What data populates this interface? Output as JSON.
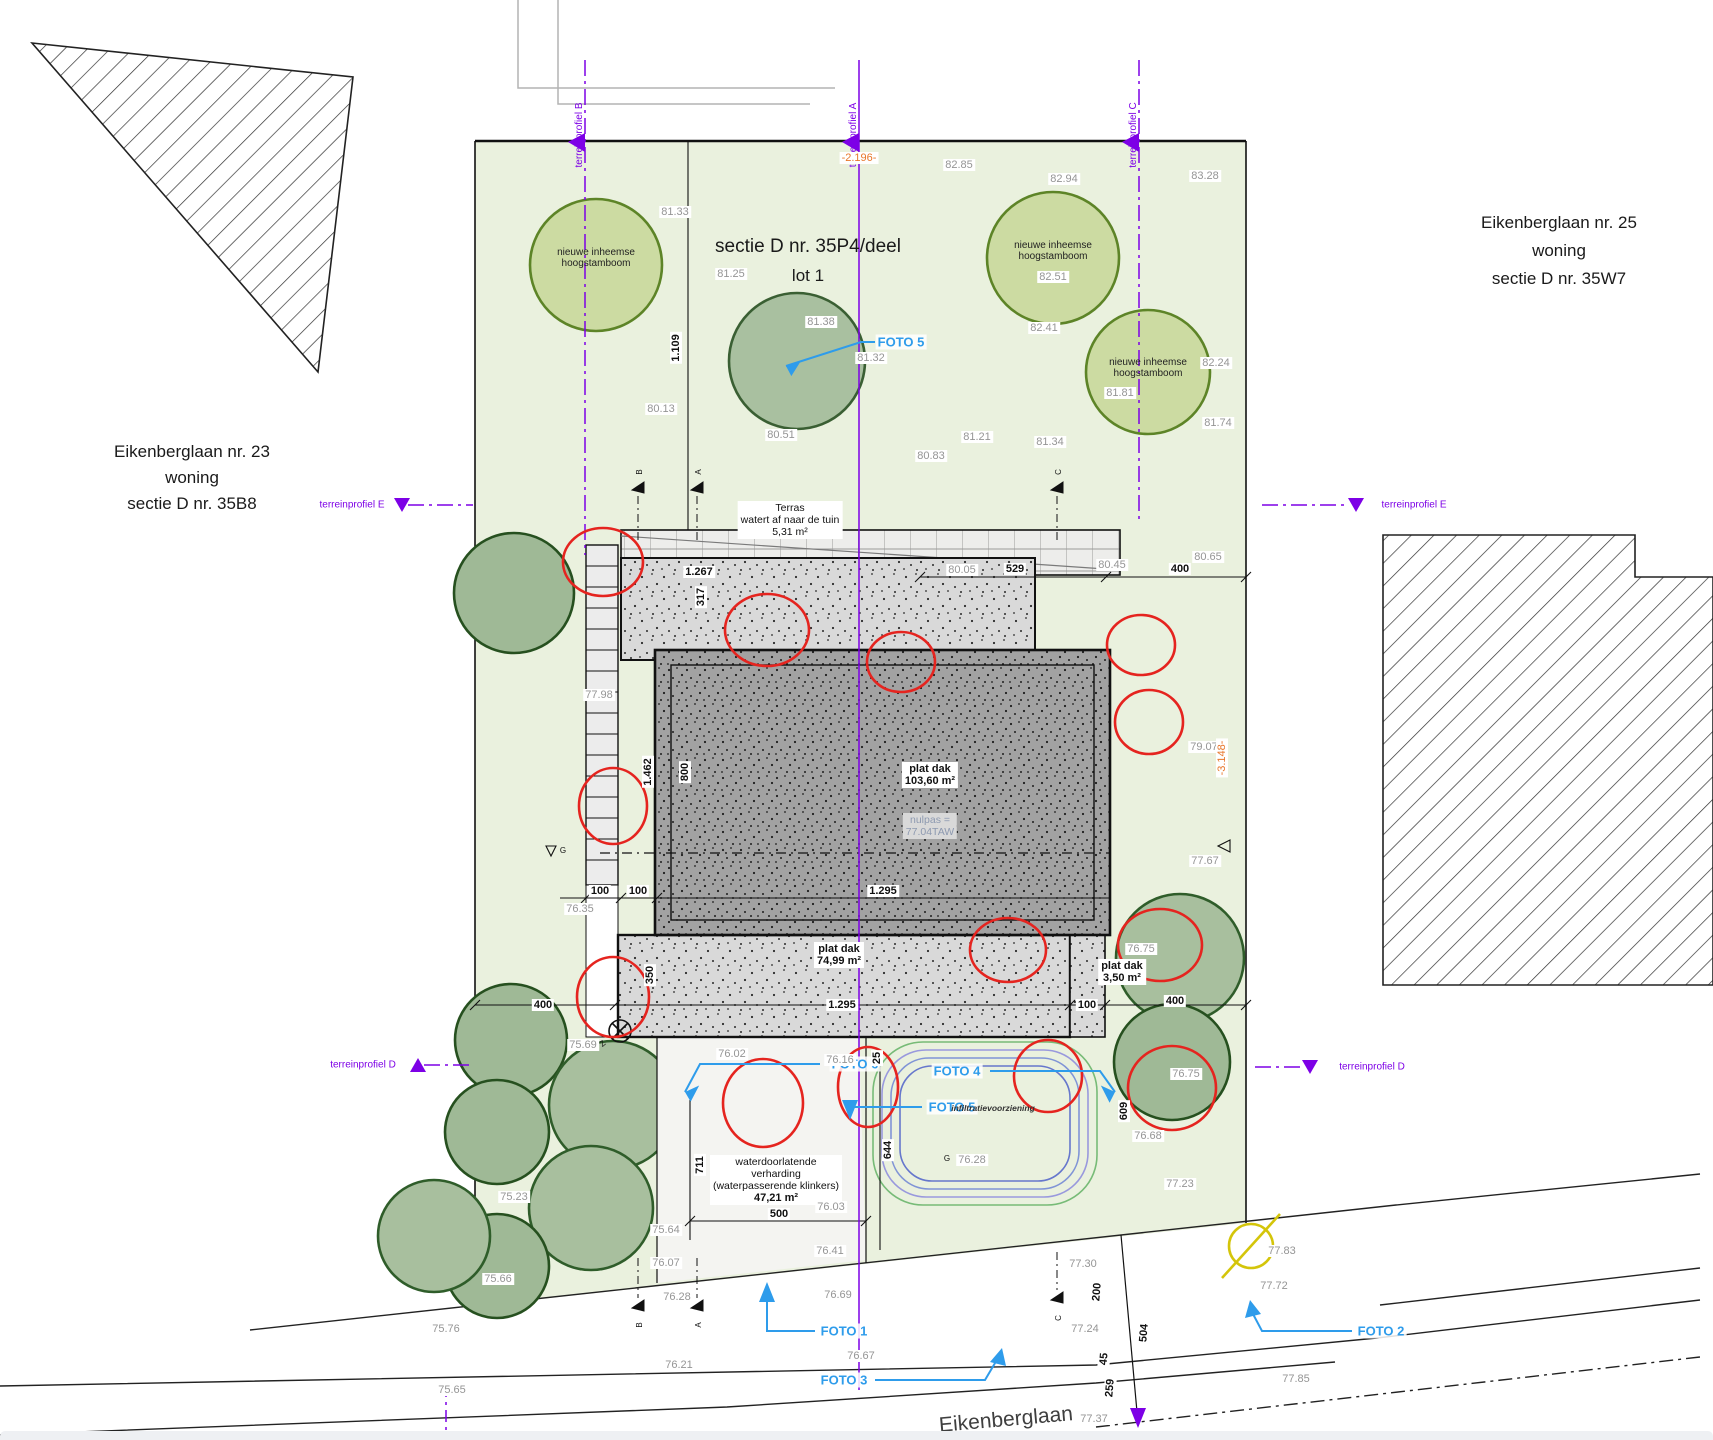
{
  "colors": {
    "site_green": "#eaf1de",
    "tree_light": "#ccdba2",
    "tree_light_stroke": "#5d8427",
    "tree_sage": "#a9c0a0",
    "tree_sage_stroke": "#2f5d2a",
    "roof_light": "#d9d9d9",
    "roof_dark": "#a2a2a2",
    "purple": "#7d00e6",
    "foto_blue": "#2e9ceb",
    "orange": "#e8762a",
    "red": "#e5241f",
    "yellow": "#d4c50a",
    "spot_gray": "#959595"
  },
  "title": {
    "line1": "sectie D nr. 35P4/deel",
    "line2": "lot 1"
  },
  "neighbors": {
    "left": {
      "line1": "Eikenberglaan nr. 23",
      "line2": "woning",
      "line3": "sectie D nr. 35B8"
    },
    "right": {
      "line1": "Eikenberglaan nr. 25",
      "line2": "woning",
      "line3": "sectie D nr. 35W7"
    }
  },
  "street": {
    "name": "Eikenberglaan"
  },
  "profiles": {
    "a": "terreinprofiel A",
    "b": "terreinprofiel B",
    "c": "terreinprofiel C",
    "d_left": "terreinprofiel D",
    "d_right": "terreinprofiel D",
    "e_left": "terreinprofiel E",
    "e_right": "terreinprofiel E"
  },
  "fotos": {
    "f1": "FOTO 1",
    "f2": "FOTO 2",
    "f3": "FOTO 3",
    "f4": "FOTO 4",
    "f5_top": "FOTO 5",
    "f5_bottom": "FOTO 5",
    "f6": "FOTO 6"
  },
  "tree_label": {
    "line1": "nieuwe inheemse",
    "line2": "hoogstamboom"
  },
  "house": {
    "terras": {
      "line1": "Terras",
      "line2": "watert af naar de tuin",
      "line3": "5,31 m²"
    },
    "roof_main": {
      "line1": "plat dak",
      "line2": "103,60 m²"
    },
    "nulpas": {
      "line1": "nulpas =",
      "line2": "77.04TAW"
    },
    "roof_low": {
      "line1": "plat dak",
      "line2": "74,99 m²"
    },
    "roof_small": {
      "line1": "plat dak",
      "line2": "3,50 m²"
    },
    "paving": {
      "line1": "waterdoorlatende",
      "line2": "verharding",
      "line3": "(waterpasserende klinkers)",
      "line4": "47,21 m²"
    },
    "infiltration": "infiltratievoorziening"
  },
  "spot_heights": [
    {
      "x": 675,
      "y": 212,
      "v": "81.33"
    },
    {
      "x": 731,
      "y": 274,
      "v": "81.25"
    },
    {
      "x": 821,
      "y": 322,
      "v": "81.38"
    },
    {
      "x": 871,
      "y": 358,
      "v": "81.32"
    },
    {
      "x": 661,
      "y": 409,
      "v": "80.13"
    },
    {
      "x": 781,
      "y": 435,
      "v": "80.51"
    },
    {
      "x": 931,
      "y": 456,
      "v": "80.83"
    },
    {
      "x": 977,
      "y": 437,
      "v": "81.21"
    },
    {
      "x": 1050,
      "y": 442,
      "v": "81.34"
    },
    {
      "x": 959,
      "y": 165,
      "v": "82.85"
    },
    {
      "x": 1064,
      "y": 179,
      "v": "82.94"
    },
    {
      "x": 1205,
      "y": 176,
      "v": "83.28"
    },
    {
      "x": 1053,
      "y": 277,
      "v": "82.51"
    },
    {
      "x": 1044,
      "y": 328,
      "v": "82.41"
    },
    {
      "x": 1216,
      "y": 363,
      "v": "82.24"
    },
    {
      "x": 1120,
      "y": 393,
      "v": "81.81"
    },
    {
      "x": 1218,
      "y": 423,
      "v": "81.74"
    },
    {
      "x": 1208,
      "y": 557,
      "v": "80.65"
    },
    {
      "x": 1112,
      "y": 565,
      "v": "80.45"
    },
    {
      "x": 962,
      "y": 570,
      "v": "80.05"
    },
    {
      "x": 599,
      "y": 695,
      "v": "77.98"
    },
    {
      "x": 1204,
      "y": 747,
      "v": "79.07"
    },
    {
      "x": 1205,
      "y": 861,
      "v": "77.67"
    },
    {
      "x": 580,
      "y": 909,
      "v": "76.35"
    },
    {
      "x": 583,
      "y": 1045,
      "v": "75.69"
    },
    {
      "x": 732,
      "y": 1054,
      "v": "76.02"
    },
    {
      "x": 840,
      "y": 1060,
      "v": "76.16"
    },
    {
      "x": 1141,
      "y": 949,
      "v": "76.75"
    },
    {
      "x": 1186,
      "y": 1074,
      "v": "76.75"
    },
    {
      "x": 1148,
      "y": 1136,
      "v": "76.68"
    },
    {
      "x": 1180,
      "y": 1184,
      "v": "77.23"
    },
    {
      "x": 831,
      "y": 1207,
      "v": "76.03"
    },
    {
      "x": 830,
      "y": 1251,
      "v": "76.41"
    },
    {
      "x": 666,
      "y": 1230,
      "v": "75.64"
    },
    {
      "x": 666,
      "y": 1263,
      "v": "76.07"
    },
    {
      "x": 514,
      "y": 1197,
      "v": "75.23"
    },
    {
      "x": 498,
      "y": 1279,
      "v": "75.66"
    },
    {
      "x": 446,
      "y": 1329,
      "v": "75.76"
    },
    {
      "x": 677,
      "y": 1297,
      "v": "76.28"
    },
    {
      "x": 838,
      "y": 1295,
      "v": "76.69"
    },
    {
      "x": 679,
      "y": 1365,
      "v": "76.21"
    },
    {
      "x": 452,
      "y": 1390,
      "v": "75.65"
    },
    {
      "x": 861,
      "y": 1356,
      "v": "76.67"
    },
    {
      "x": 1083,
      "y": 1264,
      "v": "77.30"
    },
    {
      "x": 1085,
      "y": 1329,
      "v": "77.24"
    },
    {
      "x": 1274,
      "y": 1286,
      "v": "77.72"
    },
    {
      "x": 1282,
      "y": 1251,
      "v": "77.83"
    },
    {
      "x": 1296,
      "y": 1379,
      "v": "77.85"
    },
    {
      "x": 1094,
      "y": 1419,
      "v": "77.37"
    },
    {
      "x": 972,
      "y": 1160,
      "v": "76.28"
    }
  ],
  "dims": [
    {
      "x": 676,
      "y": 348,
      "v": "1.109",
      "r": -90
    },
    {
      "x": 1015,
      "y": 569,
      "v": "529",
      "r": 0
    },
    {
      "x": 1180,
      "y": 569,
      "v": "400",
      "r": 0
    },
    {
      "x": 699,
      "y": 572,
      "v": "1.267",
      "r": 0
    },
    {
      "x": 701,
      "y": 597,
      "v": "317",
      "r": -90
    },
    {
      "x": 648,
      "y": 772,
      "v": "1.462",
      "r": -90
    },
    {
      "x": 685,
      "y": 772,
      "v": "800",
      "r": -90
    },
    {
      "x": 600,
      "y": 891,
      "v": "100",
      "r": 0
    },
    {
      "x": 638,
      "y": 891,
      "v": "100",
      "r": 0
    },
    {
      "x": 883,
      "y": 891,
      "v": "1.295",
      "r": 0
    },
    {
      "x": 650,
      "y": 975,
      "v": "350",
      "r": -90
    },
    {
      "x": 543,
      "y": 1005,
      "v": "400",
      "r": 0
    },
    {
      "x": 842,
      "y": 1005,
      "v": "1.295",
      "r": 0
    },
    {
      "x": 1087,
      "y": 1005,
      "v": "100",
      "r": 0
    },
    {
      "x": 1175,
      "y": 1001,
      "v": "400",
      "r": 0
    },
    {
      "x": 877,
      "y": 1058,
      "v": "25",
      "r": -90
    },
    {
      "x": 888,
      "y": 1150,
      "v": "644",
      "r": -90
    },
    {
      "x": 700,
      "y": 1165,
      "v": "711",
      "r": -90
    },
    {
      "x": 779,
      "y": 1214,
      "v": "500",
      "r": 0
    },
    {
      "x": 1124,
      "y": 1111,
      "v": "609",
      "r": -90
    },
    {
      "x": 1097,
      "y": 1292,
      "v": "200",
      "r": -85
    },
    {
      "x": 1144,
      "y": 1333,
      "v": "504",
      "r": -85
    },
    {
      "x": 1104,
      "y": 1359,
      "v": "45",
      "r": -85
    },
    {
      "x": 1110,
      "y": 1388,
      "v": "259",
      "r": -85
    }
  ],
  "orange_dims": [
    {
      "x": 859,
      "y": 158,
      "v": "-2.196-",
      "r": 0
    },
    {
      "x": 1222,
      "y": 758,
      "v": "-3.148-",
      "r": -90
    }
  ],
  "markers": [
    {
      "x": 640,
      "y": 472,
      "v": "B",
      "r": -90
    },
    {
      "x": 699,
      "y": 472,
      "v": "A",
      "r": -90
    },
    {
      "x": 1059,
      "y": 472,
      "v": "C",
      "r": -90
    },
    {
      "x": 640,
      "y": 1325,
      "v": "B",
      "r": -90
    },
    {
      "x": 699,
      "y": 1325,
      "v": "A",
      "r": -90
    },
    {
      "x": 1059,
      "y": 1318,
      "v": "C",
      "r": -90
    },
    {
      "x": 563,
      "y": 851,
      "v": "G",
      "r": 0
    },
    {
      "x": 947,
      "y": 1159,
      "v": "G",
      "r": 0
    },
    {
      "x": 603,
      "y": 1044,
      "v": "Z",
      "r": -40
    }
  ]
}
